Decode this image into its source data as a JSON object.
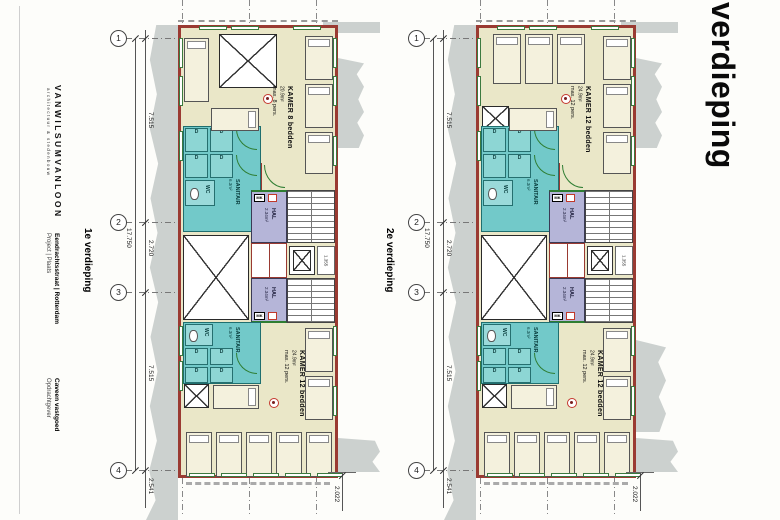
{
  "sidebar": {
    "firm": "VANWILSUMVANLOON",
    "firm_sub": "architectuur & stedenbouw",
    "project_label": "Project | Plaats",
    "project_value": "Eendrachtsstraat | Rotterdam",
    "client_label": "Opdrachtgever",
    "client_value": "Caveen vastgoed"
  },
  "titles": {
    "big_title": "verdieping"
  },
  "dimensions": {
    "grid_markers": [
      "1",
      "2",
      "3",
      "4"
    ],
    "left_total": "17.750",
    "seg_top": "7.515",
    "seg_mid": "2.720",
    "seg_bottom": "7.515",
    "seg_below": "2.541",
    "right_bottom": "2.022",
    "core_dim": "1.355"
  },
  "shared_labels": {
    "sanitair": "SANITAIR",
    "sanitair_area": "6.3m²",
    "wc": "WC",
    "shower": "D",
    "hal": "HAL",
    "hal_area": "2.34m²",
    "mk": "MK"
  },
  "plans": [
    {
      "name": "1e verdieping",
      "top_room": {
        "name": "KAMER 8 bedden",
        "area": "20.9m²",
        "capacity": "max. 8 pers."
      },
      "bottom_room": {
        "name": "KAMER 12 bedden",
        "area": "24.9m²",
        "capacity": "max. 12 pers."
      }
    },
    {
      "name": "2e verdieping",
      "top_room": {
        "name": "KAMER 12 bedden",
        "area": "24.9m²",
        "capacity": "max. 12 pers."
      },
      "bottom_room": {
        "name": "KAMER 12 bedden",
        "area": "24.9m²",
        "capacity": "max. 12 pers."
      }
    }
  ],
  "colors": {
    "wall": "#9a3a32",
    "room_fill": "#eae7c8",
    "sanitary_fill": "#72c9c9",
    "hall_fill": "#b5b5d8",
    "context_gray": "#ccd1cf",
    "window_green": "#3c7a3f",
    "badge_red": "#c4372e"
  }
}
